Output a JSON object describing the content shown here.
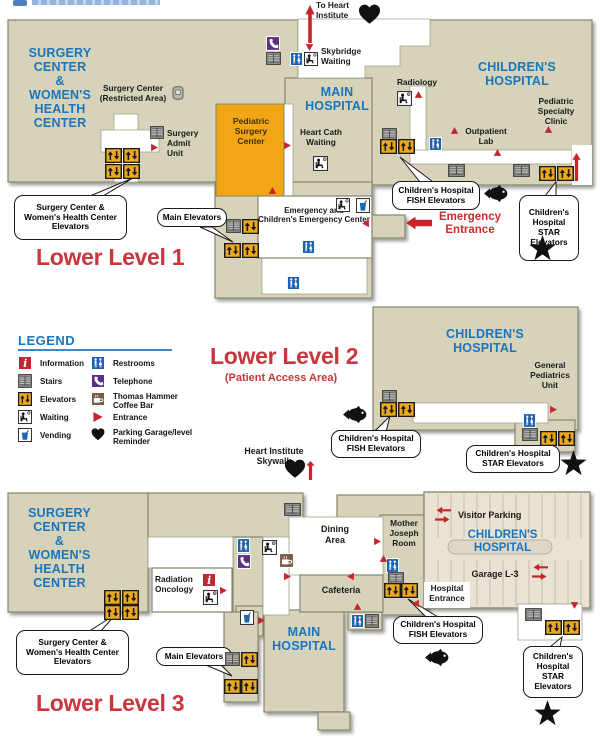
{
  "header": {
    "to_heart_institute": "To Heart\nInstitute"
  },
  "level1": {
    "title": "Lower Level 1",
    "surgery_center": "SURGERY\nCENTER\n&\nWOMEN'S\nHEALTH\nCENTER",
    "surgery_center_restricted": "Surgery Center\n(Restricted Area)",
    "surgery_admit": "Surgery\nAdmit\nUnit",
    "pediatric_surgery": "Pediatric\nSurgery\nCenter",
    "main_hospital": "MAIN\nHOSPITAL",
    "skybridge_waiting": "Skybridge\nWaiting",
    "heart_cath": "Heart Cath\nWaiting",
    "radiology": "Radiology",
    "childrens_hospital": "CHILDREN'S\nHOSPITAL",
    "pediatric_specialty": "Pediatric\nSpecialty\nClinic",
    "outpatient_lab": "Outpatient\nLab",
    "emergency_center": "Emergency and\nChildren's Emergency Center",
    "emergency_entrance": "Emergency\nEntrance",
    "callout_swhc": "Surgery Center &\nWomen's Health Center\nElevators",
    "callout_main": "Main Elevators",
    "callout_fish": "Children's Hospital\nFISH Elevators",
    "callout_star": "Children's\nHospital\nSTAR\nElevators"
  },
  "legend": {
    "title": "LEGEND",
    "col1": [
      {
        "icon": "information",
        "label": "Information"
      },
      {
        "icon": "stairs",
        "label": "Stairs"
      },
      {
        "icon": "elevator",
        "label": "Elevators"
      },
      {
        "icon": "waiting",
        "label": "Waiting"
      },
      {
        "icon": "vending",
        "label": "Vending"
      }
    ],
    "col2": [
      {
        "icon": "restrooms",
        "label": "Restrooms"
      },
      {
        "icon": "telephone",
        "label": "Telephone"
      },
      {
        "icon": "coffee",
        "label": "Thomas Hammer\nCoffee Bar"
      },
      {
        "icon": "entrance",
        "label": "Entrance"
      },
      {
        "icon": "heart",
        "label": "Parking Garage/level\nReminder"
      }
    ]
  },
  "level2": {
    "title": "Lower Level 2",
    "subtitle": "(Patient Access Area)",
    "childrens_hospital": "CHILDREN'S\nHOSPITAL",
    "general_pediatrics": "General\nPediatrics\nUnit",
    "callout_fish": "Children's Hospital\nFISH Elevators",
    "callout_star": "Children's Hospital\nSTAR Elevators",
    "heart_skywalk": "Heart Institute\nSkywalk"
  },
  "level3": {
    "title": "Lower Level 3",
    "surgery_center": "SURGERY\nCENTER\n&\nWOMEN'S\nHEALTH\nCENTER",
    "radiation_oncology": "Radiation\nOncology",
    "dining_area": "Dining\nArea",
    "cafeteria": "Cafeteria",
    "mother_joseph": "Mother\nJoseph\nRoom",
    "main_hospital": "MAIN\nHOSPITAL",
    "visitor_parking": "Visitor Parking",
    "childrens_hospital": "CHILDREN'S\nHOSPITAL",
    "garage": "Garage L-3",
    "hospital_entrance": "Hospital\nEntrance",
    "callout_swhc": "Surgery Center &\nWomen's Health Center\nElevators",
    "callout_main": "Main Elevators",
    "callout_fish": "Children's Hospital\nFISH Elevators",
    "callout_star": "Children's\nHospital\nSTAR\nElevators"
  },
  "colors": {
    "building": "#d6d3ba",
    "outline": "#85856c",
    "orange_block": "#f2a515",
    "accent_blue": "#1a75bb",
    "accent_red": "#c9363c",
    "garage": "#eae3d4"
  },
  "icons": {
    "elevator": "orange square with up/down arrows",
    "stairs": "gray slatted square",
    "restrooms": "blue square with man and woman",
    "telephone": "purple square with handset",
    "information": "red square with letter i",
    "waiting": "white square with seated person and clock",
    "vending": "white square with blue cup",
    "coffee": "brown square with mug",
    "entrance": "red triangle",
    "heart": "black heart",
    "fish": "black fish",
    "star": "black star",
    "up_arrow": "red up arrow",
    "left_arrow": "red left arrow",
    "double_arrows": "red circulation arrows",
    "restricted": "gray badge reader"
  }
}
